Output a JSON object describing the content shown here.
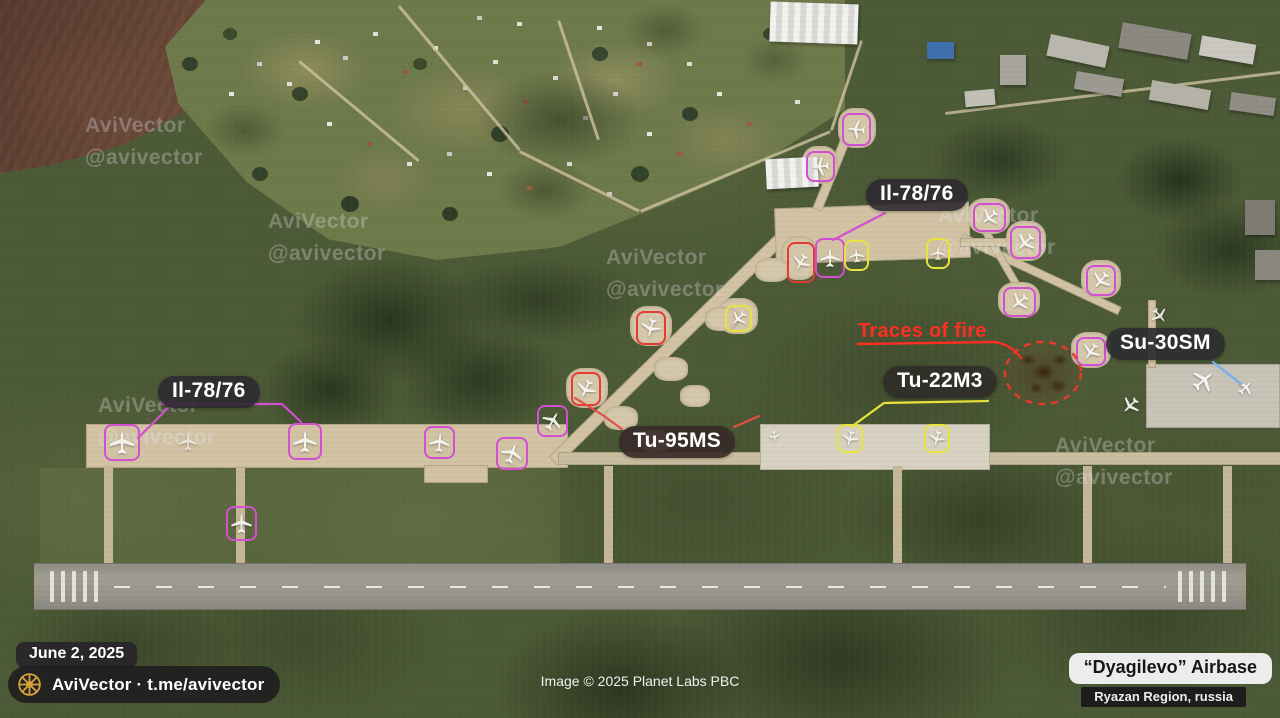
{
  "watermark": {
    "line1": "AviVector",
    "line2": "@avivector",
    "positions": [
      {
        "x": 85,
        "y": 110
      },
      {
        "x": 268,
        "y": 206
      },
      {
        "x": 606,
        "y": 242
      },
      {
        "x": 98,
        "y": 390
      },
      {
        "x": 938,
        "y": 200
      },
      {
        "x": 1055,
        "y": 430
      }
    ]
  },
  "annotation_colors": {
    "magenta": "#d24fd2",
    "red": "#e23c34",
    "yellow": "#e8e33e",
    "blue": "#6fb0f0",
    "fire": "#ff2d23"
  },
  "labels": {
    "il78_top": "Il-78/76",
    "il78_left": "Il-78/76",
    "tu95": "Tu-95MS",
    "tu22": "Tu-22M3",
    "su30": "Su-30SM",
    "traces_of_fire": "Traces of fire"
  },
  "footer": {
    "date": "June 2, 2025",
    "channel": "AviVector · t.me/avivector",
    "image_credit": "Image © 2025 Planet Labs PBC",
    "airbase_name": "“Dyagilevo” Airbase",
    "airbase_region": "Ryazan Region, russia"
  },
  "scene": {
    "aircraft_markers": [
      {
        "x": 104,
        "y": 424,
        "w": 36,
        "h": 37,
        "color": "magenta",
        "rot": 0
      },
      {
        "x": 288,
        "y": 423,
        "w": 34,
        "h": 37,
        "color": "magenta",
        "rot": 0
      },
      {
        "x": 424,
        "y": 426,
        "w": 31,
        "h": 33,
        "color": "magenta",
        "rot": 5
      },
      {
        "x": 496,
        "y": 437,
        "w": 32,
        "h": 33,
        "color": "magenta",
        "rot": 20
      },
      {
        "x": 537,
        "y": 405,
        "w": 31,
        "h": 32,
        "color": "magenta",
        "rot": 30
      },
      {
        "x": 226,
        "y": 506,
        "w": 31,
        "h": 35,
        "color": "magenta",
        "rot": 0
      },
      {
        "x": 815,
        "y": 238,
        "w": 30,
        "h": 40,
        "color": "magenta",
        "rot": 0
      },
      {
        "x": 842,
        "y": 113,
        "w": 29,
        "h": 33,
        "color": "magenta",
        "rot": 275
      },
      {
        "x": 806,
        "y": 151,
        "w": 29,
        "h": 31,
        "color": "magenta",
        "rot": 265
      },
      {
        "x": 973,
        "y": 203,
        "w": 33,
        "h": 29,
        "color": "magenta",
        "rot": 230
      },
      {
        "x": 1010,
        "y": 226,
        "w": 31,
        "h": 33,
        "color": "magenta",
        "rot": 225
      },
      {
        "x": 1086,
        "y": 265,
        "w": 30,
        "h": 31,
        "color": "magenta",
        "rot": 220
      },
      {
        "x": 1003,
        "y": 287,
        "w": 33,
        "h": 30,
        "color": "magenta",
        "rot": 230
      },
      {
        "x": 1076,
        "y": 337,
        "w": 30,
        "h": 29,
        "color": "magenta",
        "rot": 215
      },
      {
        "x": 571,
        "y": 372,
        "w": 30,
        "h": 34,
        "color": "red",
        "rot": 205
      },
      {
        "x": 636,
        "y": 311,
        "w": 30,
        "h": 34,
        "color": "red",
        "rot": 195
      },
      {
        "x": 787,
        "y": 242,
        "w": 28,
        "h": 41,
        "color": "red",
        "rot": 210
      },
      {
        "x": 725,
        "y": 305,
        "w": 27,
        "h": 27,
        "color": "yellow",
        "rot": 225
      },
      {
        "x": 844,
        "y": 240,
        "w": 25,
        "h": 31,
        "color": "yellow",
        "rot": 355
      },
      {
        "x": 926,
        "y": 238,
        "w": 24,
        "h": 31,
        "color": "yellow",
        "rot": 0
      },
      {
        "x": 837,
        "y": 424,
        "w": 26,
        "h": 29,
        "color": "yellow",
        "rot": 195
      },
      {
        "x": 924,
        "y": 424,
        "w": 26,
        "h": 29,
        "color": "yellow",
        "rot": 195
      }
    ],
    "unboxed_aircraft": [
      {
        "x": 176,
        "y": 427,
        "w": 24,
        "h": 30,
        "rot": 0,
        "opacity": 0.75
      },
      {
        "x": 766,
        "y": 427,
        "w": 17,
        "h": 19,
        "rot": 170,
        "opacity": 0.9
      },
      {
        "x": 1118,
        "y": 392,
        "w": 25,
        "h": 27,
        "rot": 225,
        "opacity": 0.95
      },
      {
        "x": 1188,
        "y": 364,
        "w": 31,
        "h": 33,
        "rot": 50,
        "opacity": 0.95
      },
      {
        "x": 1234,
        "y": 375,
        "w": 23,
        "h": 25,
        "rot": 45,
        "opacity": 0.95
      },
      {
        "x": 1148,
        "y": 303,
        "w": 23,
        "h": 25,
        "rot": 140,
        "opacity": 0.9
      }
    ],
    "fire_area": {
      "cx": 1043,
      "cy": 373,
      "rx": 38,
      "ry": 31
    }
  }
}
